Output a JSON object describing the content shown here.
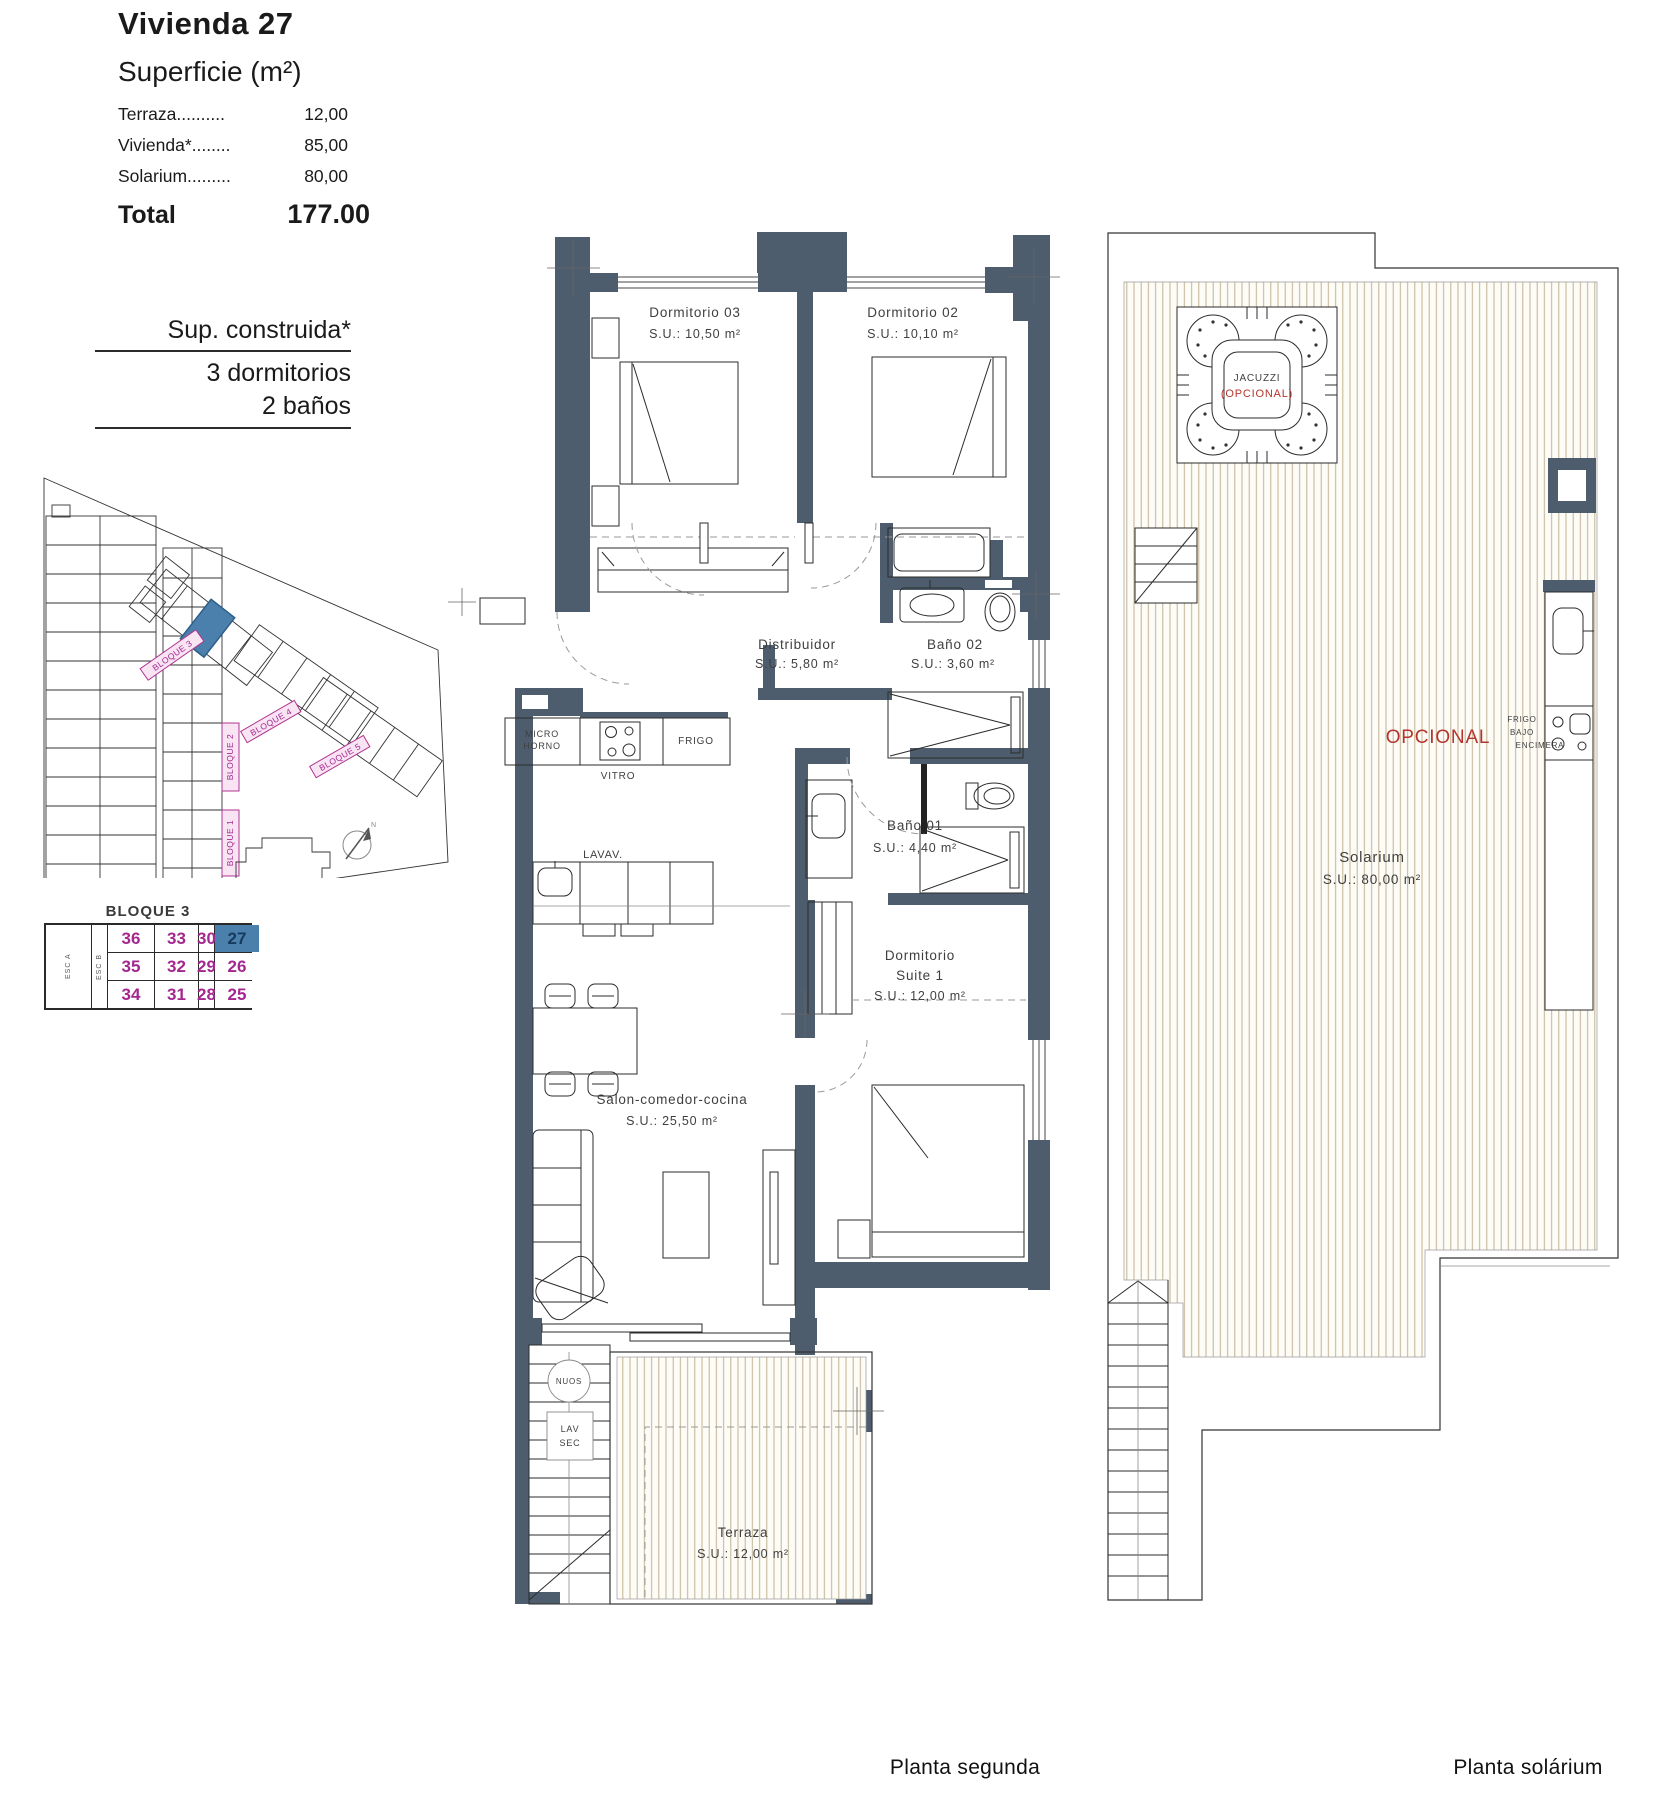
{
  "header": {
    "title": "Vivienda 27",
    "subtitle": "Superficie (m²)",
    "rows": [
      {
        "label": "Terraza..........",
        "value": "12,00"
      },
      {
        "label": "Vivienda*........",
        "value": "85,00"
      },
      {
        "label": "Solarium.........",
        "value": "80,00"
      }
    ],
    "total_label": "Total",
    "total_value": "177.00"
  },
  "spec": {
    "line1": "Sup. construida*",
    "line2": "3 dormitorios",
    "line3": "2 baños"
  },
  "site_plan": {
    "bloque1": "BLOQUE 1",
    "bloque2": "BLOQUE 2",
    "bloque3": "BLOQUE 3",
    "bloque4": "BLOQUE 4",
    "bloque5": "BLOQUE 5",
    "north": "N"
  },
  "unit_table": {
    "title": "BLOQUE 3",
    "esc_a": "ESC A",
    "esc_b": "ESC B",
    "highlighted_unit": "27",
    "rows": [
      [
        "36",
        "33",
        "30",
        "27"
      ],
      [
        "35",
        "32",
        "29",
        "26"
      ],
      [
        "34",
        "31",
        "28",
        "25"
      ]
    ]
  },
  "planta_segunda": {
    "caption": "Planta segunda",
    "dormitorio03": {
      "name": "Dormitorio 03",
      "area": "S.U.: 10,50 m²"
    },
    "dormitorio02": {
      "name": "Dormitorio 02",
      "area": "S.U.: 10,10 m²"
    },
    "distribuidor": {
      "name": "Distribuidor",
      "area": "S.U.: 5,80 m²"
    },
    "bano02": {
      "name": "Baño 02",
      "area": "S.U.: 3,60 m²"
    },
    "bano01": {
      "name": "Baño 01",
      "area": "S.U.: 4,40 m²"
    },
    "suite": {
      "name1": "Dormitorio",
      "name2": "Suite 1",
      "area": "S.U.: 12,00 m²"
    },
    "salon": {
      "name": "Salon-comedor-cocina",
      "area": "S.U.: 25,50 m²"
    },
    "terraza": {
      "name": "Terraza",
      "area": "S.U.: 12,00 m²"
    },
    "kitchen": {
      "micro1": "MICRO",
      "micro2": "HORNO",
      "vitro": "VITRO",
      "frigo": "FRIGO",
      "lavav": "LAVAV."
    },
    "stairs": {
      "heater": "NUOS",
      "lav": "LAV",
      "sec": "SEC"
    }
  },
  "planta_solarium": {
    "caption": "Planta solárium",
    "solarium": {
      "name": "Solarium",
      "area": "S.U.: 80,00 m²"
    },
    "jacuzzi": {
      "line1": "JACUZZI",
      "line2": "(OPCIONAL)"
    },
    "opcional": "OPCIONAL",
    "counter": {
      "line1": "FRIGO",
      "line2": "BAJO",
      "line3": "ENCIMERA"
    }
  },
  "colors": {
    "wall": "#4e5d6e",
    "deck_stripe": "#c3b294",
    "magenta": "#a3278f",
    "label_pink_fill": "#f9e4f4",
    "highlight_blue": "#4b80ad",
    "accent_red": "#b5352d"
  }
}
